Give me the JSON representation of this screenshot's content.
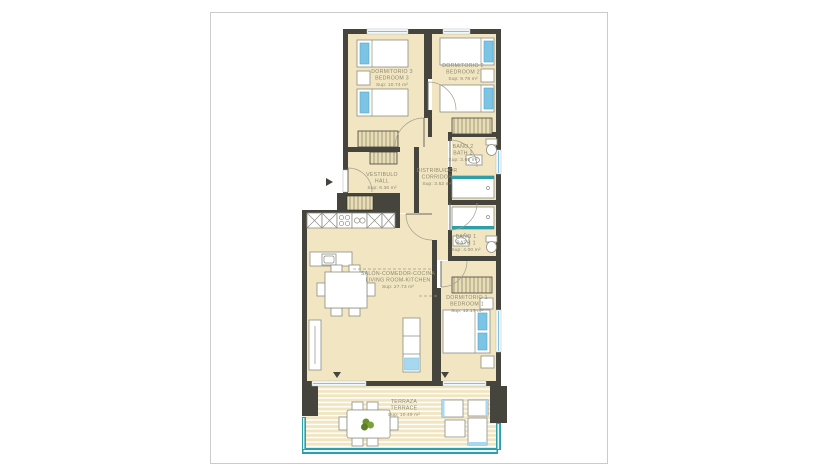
{
  "canvas": {
    "background": "#ffffff"
  },
  "page": {
    "background": "#ffffff",
    "border_color": "#cbcbcb"
  },
  "palette": {
    "wall": "#45453e",
    "floor": "#f1e6c1",
    "accent_blue": "#7cc4e4",
    "glass_teal": "#2e9fa8",
    "furniture_stroke": "#8d8d85",
    "label_text": "#8c8870",
    "plant_green": "#6b8f2e"
  },
  "rooms": {
    "bedroom3": {
      "name_es": "DORMITORIO 3",
      "name_en": "BEDROOM 3",
      "area": "Sup: 10.74 m²"
    },
    "bedroom2": {
      "name_es": "DORMITORIO 2",
      "name_en": "BEDROOM 2",
      "area": "Sup: 9.78 m²"
    },
    "bath2": {
      "name_es": "BAÑO 2",
      "name_en": "BATH 2",
      "area": "Sup: 3.66 m²"
    },
    "hall": {
      "name_es": "VESTIBULO",
      "name_en": "HALL",
      "area": "Sup: 6.36 m²"
    },
    "corridor": {
      "name_es": "DISTRIBUIDOR",
      "name_en": "CORRIDOR",
      "area": "Sup: 3.52 m²"
    },
    "bath1": {
      "name_es": "BAÑO 1",
      "name_en": "BATH 1",
      "area": "Sup: 4.00 m²"
    },
    "living": {
      "name_es": "SALÓN-COMEDOR-COCINA",
      "name_en": "LIVING ROOM-KITCHEN",
      "area": "Sup: 27.73 m²"
    },
    "bedroom1": {
      "name_es": "DORMITORIO 1",
      "name_en": "BEDROOM 1",
      "area": "Sup: 12.17 m²"
    },
    "terrace": {
      "name_es": "TERRAZA",
      "name_en": "TERRACE",
      "area": "Sup: 10.49 m²"
    }
  },
  "icons": {
    "entrance_marker": "entrance-arrow-icon",
    "door_swing": "door-swing-icon",
    "plant": "plant-icon"
  }
}
